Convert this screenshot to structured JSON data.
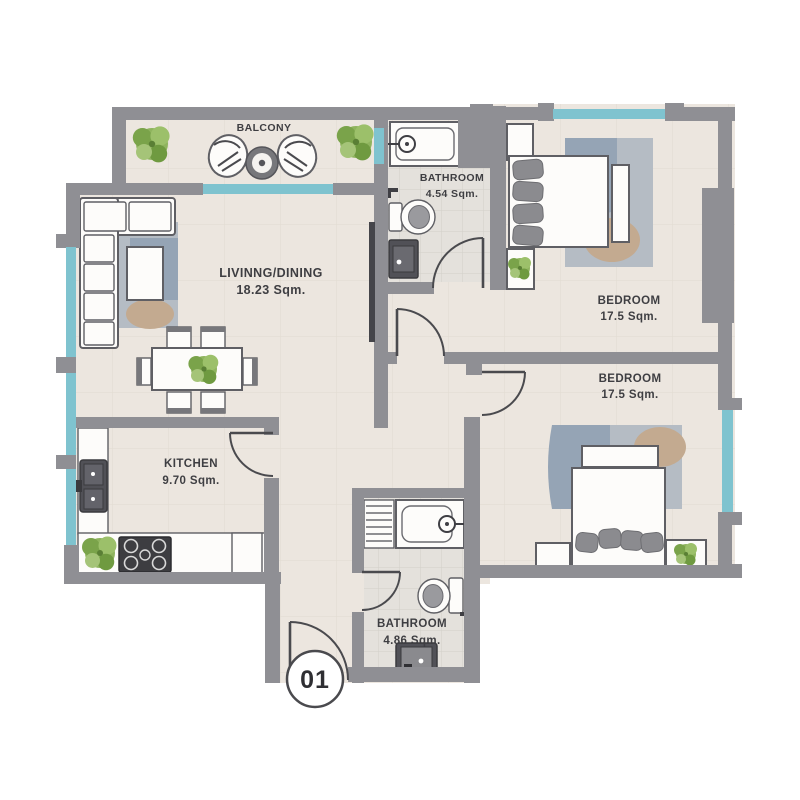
{
  "unit": {
    "number": "01"
  },
  "rooms": {
    "balcony": {
      "label": "BALCONY"
    },
    "living_dining": {
      "label": "LIVINNG/DINING",
      "area": "18.23 Sqm."
    },
    "bathroom_top": {
      "label": "BATHROOM",
      "area": "4.54 Sqm."
    },
    "bedroom_top": {
      "label": "BEDROOM",
      "area": "17.5 Sqm."
    },
    "bedroom_bottom": {
      "label": "BEDROOM",
      "area": "17.5 Sqm."
    },
    "kitchen": {
      "label": "KITCHEN",
      "area": "9.70 Sqm."
    },
    "bathroom_bottom": {
      "label": "BATHROOM",
      "area": "4.86 Sqm."
    }
  },
  "colors": {
    "wall": "#8f8f94",
    "window": "#7fc3cf",
    "floor": "#ece6df",
    "floor-bath": "#e4e1dc",
    "tile-line": "#ddd6cc",
    "tile-line-bath": "#d1cdc7",
    "furniture-line": "#5f5f64",
    "label-text": "#3e3e42",
    "plant-green": "#8fb45e",
    "rug": "#b5bcc4",
    "rug-accent": "#95a4b5",
    "rug-tan": "#c3aa90",
    "dark-fixture": "#515157",
    "pillow": "#8b8b8f"
  }
}
